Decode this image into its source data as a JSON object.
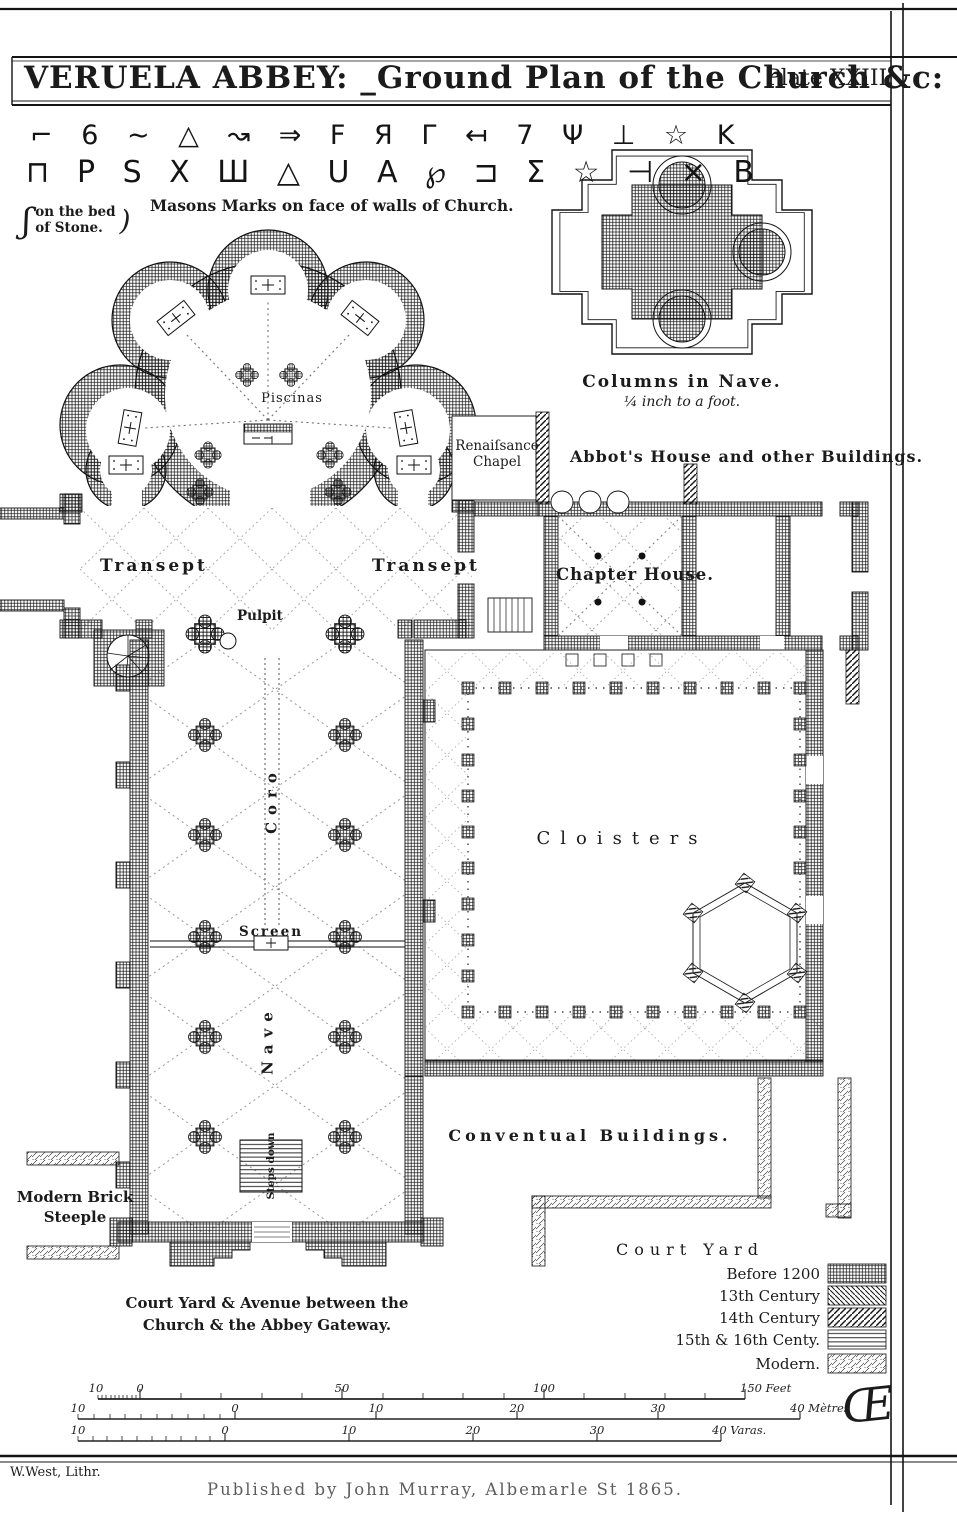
{
  "header": {
    "title": "VERUELA ABBEY: _Ground Plan of the Church &c:",
    "plate_no": "Plate XXIII."
  },
  "masons": {
    "row1": "⌐ 6 ∼ △ ↝ ⇒ Ϝ Я Γ ↤ 7 Ψ ⊥ ☆ K",
    "row2": "⊓ P S X Ш △ U A ℘ ⊐ Σ ☆ ⊣ × B",
    "caption": "Masons Marks on face of walls of Church.",
    "bed_open_glyph": "ʃ",
    "bed_line1": "on the bed",
    "bed_line2": "of Stone.",
    "bed_close_glyph": ")"
  },
  "column_inset": {
    "caption": "Columns in Nave.",
    "scale_note": "¼ inch to a foot."
  },
  "plan_labels": {
    "renaissance_1": "Renaiſsance",
    "renaissance_2": "Chapel",
    "abbots_house": "Abbot's House and other Buildings.",
    "transept_left": "Transept",
    "transept_right": "Transept",
    "chapter_house": "Chapter House.",
    "pulpit": "Pulpit",
    "piscinas": "Piscinas",
    "coro": "Coro",
    "screen": "Screen",
    "nave": "Nave",
    "steps_down": "Steps down",
    "cloisters": "Cloisters",
    "conventual": "Conventual Buildings.",
    "court_yard": "Court Yard",
    "modern_brick_1": "Modern Brick",
    "modern_brick_2": "Steeple",
    "avenue_1": "Court Yard & Avenue between the",
    "avenue_2": "Church & the Abbey Gateway."
  },
  "legend": {
    "items": [
      {
        "label": "Before 1200",
        "hatch": "crosshatch"
      },
      {
        "label": "13th Century",
        "hatch": "diagonal-backslash"
      },
      {
        "label": "14th Century",
        "hatch": "diagonal-slash"
      },
      {
        "label": "15th & 16th Centy.",
        "hatch": "horizontal-lines"
      },
      {
        "label": "Modern.",
        "hatch": "sparse-diagonal"
      }
    ]
  },
  "scalebars": {
    "feet": {
      "labels": [
        "10",
        "0",
        "50",
        "100",
        "150 Feet"
      ]
    },
    "metres": {
      "labels": [
        "10",
        "0",
        "10",
        "20",
        "30",
        "40 Mètres"
      ]
    },
    "varas": {
      "labels": [
        "10",
        "0",
        "10",
        "20",
        "30",
        "40 Varas."
      ]
    }
  },
  "imprint": {
    "lithographer": "W.West, Lithr.",
    "publisher": "Published by John Murray, Albemarle St 1865.",
    "monogram": "Œ"
  }
}
